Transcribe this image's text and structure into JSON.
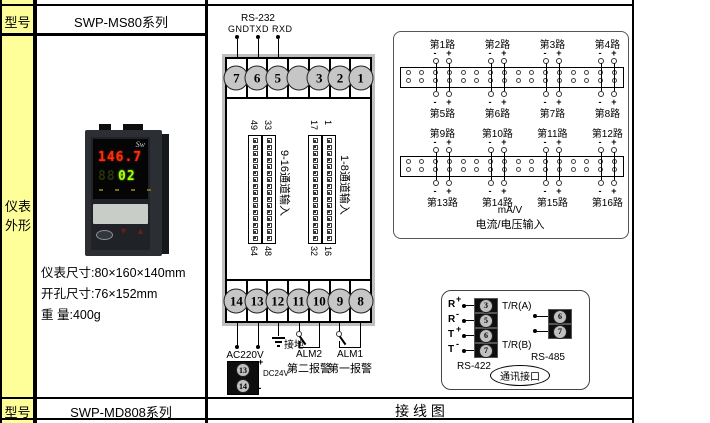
{
  "table": {
    "model_label_top": "型号",
    "model_top": "SWP-MS80系列",
    "outline_label_1": "仪表",
    "outline_label_2": "外形",
    "dim1": "仪表尺寸:80×160×140mm",
    "dim2": "开孔尺寸:76×152mm",
    "dim3": "重 量:400g",
    "model_label_bottom": "型号",
    "model_bottom": "SWP-MD808系列",
    "diagram_title": "接 线 图"
  },
  "device": {
    "logo": "Sw",
    "display_main": "146.7",
    "display_ghost": "88",
    "display_sub": "02",
    "btn_down": "▼",
    "btn_up": "▲",
    "display_main_color": "#ff2f00",
    "display_sub_color": "#aaff00"
  },
  "terminal_block": {
    "rs232_title": "RS-232",
    "rs232_pins": "GNDTXD RXD",
    "top_terminals": [
      "7",
      "6",
      "5",
      "",
      "3",
      "2",
      "1"
    ],
    "bottom_terminals": [
      "14",
      "13",
      "12",
      "11",
      "10",
      "9",
      "8"
    ],
    "strips": [
      {
        "label": "9-16通道输入",
        "tl": "49",
        "tr": "33",
        "bl": "64",
        "br": "48"
      },
      {
        "label": "1-8通道输入",
        "tl": "17",
        "tr": "1",
        "bl": "32",
        "br": "16"
      }
    ],
    "ac_label": "AC220V",
    "ground_label": "接地",
    "alm2": "ALM2",
    "alm2_sub": "第二报警",
    "alm1": "ALM1",
    "alm1_sub": "第一报警",
    "dc_label": "DC24V",
    "dc_pins": [
      "13",
      "14"
    ],
    "plus": "+",
    "minus": "-"
  },
  "input_panel": {
    "strips": [
      {
        "top": [
          "第1路",
          "第2路",
          "第3路",
          "第4路"
        ],
        "bottom": [
          "第5路",
          "第6路",
          "第7路",
          "第8路"
        ]
      },
      {
        "top": [
          "第9路",
          "第10路",
          "第11路",
          "第12路"
        ],
        "bottom": [
          "第13路",
          "第14路",
          "第15路",
          "第16路"
        ]
      }
    ],
    "minus": "-",
    "plus": "+",
    "caption1": "mA/V",
    "caption2": "电流/电压输入"
  },
  "comm_box": {
    "rs422_label": "RS-422",
    "rs422_rows": [
      {
        "signal": "R",
        "sign": "+",
        "terminal": "3"
      },
      {
        "signal": "R",
        "sign": "-",
        "terminal": "5"
      },
      {
        "signal": "T",
        "sign": "+",
        "terminal": "6"
      },
      {
        "signal": "T",
        "sign": "-",
        "terminal": "7"
      }
    ],
    "rs485_label": "RS-485",
    "line_a": "T/R(A)",
    "line_b": "T/R(B)",
    "rs485_terminals": [
      "6",
      "7"
    ],
    "port_label": "通讯接口"
  },
  "colors": {
    "header_yellow": "#ffff99",
    "grid_black": "#000000",
    "terminal_gray": "#c6c6c6",
    "block_shadow": "#bfbfbf",
    "display_red": "#ff2f00",
    "display_green": "#aaff00"
  }
}
